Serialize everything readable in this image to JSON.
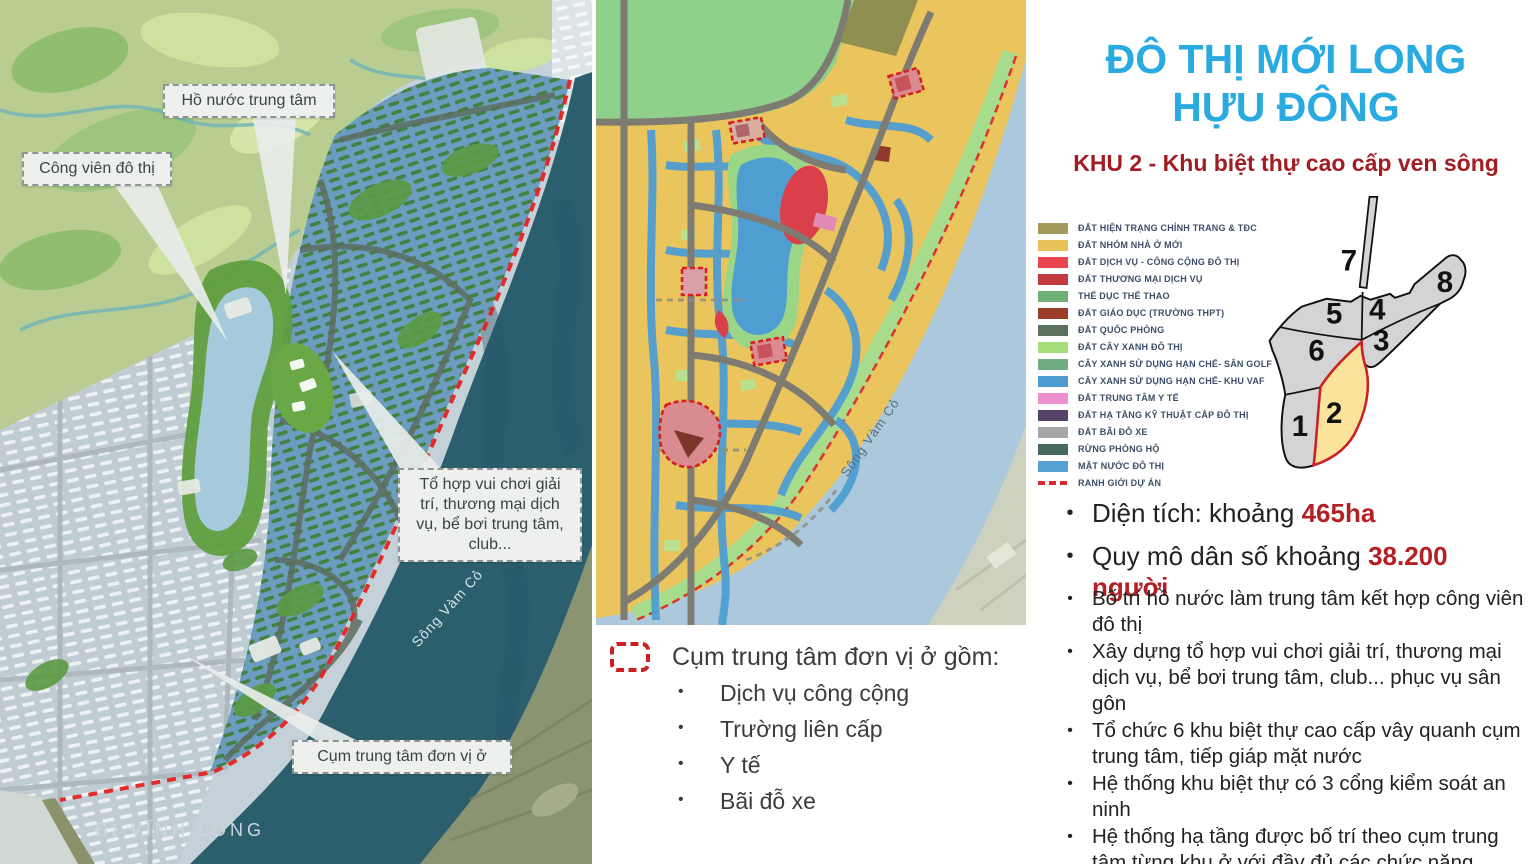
{
  "header": {
    "title_line1": "ĐÔ THỊ MỚI LONG",
    "title_line2": "HỰU ĐÔNG",
    "subtitle": "KHU 2 - Khu biệt thự cao cấp ven sông",
    "title_color": "#29abe2",
    "subtitle_color": "#a21d22"
  },
  "left_map": {
    "labels": {
      "lake": "Hồ nước trung tâm",
      "park": "Công viên đô thị",
      "complex": "Tổ hợp vui chơi giải trí, thương mại dịch vụ, bể bơi trung tâm, club...",
      "cluster": "Cụm trung tâm đơn vị ở",
      "road": "ĐI VĨNH LONG",
      "river": "Sông Vàm Cỏ"
    }
  },
  "middle_map": {
    "river_label": "Sông Vàm Cỏ"
  },
  "legend": {
    "items": [
      {
        "label": "ĐẤT HIỆN TRẠNG CHỈNH TRANG & TĐC",
        "color": "#a39a5c"
      },
      {
        "label": "ĐẤT NHÓM NHÀ Ở MỚI",
        "color": "#e5c158"
      },
      {
        "label": "ĐẤT DỊCH VỤ - CÔNG CỘNG ĐÔ THỊ",
        "color": "#e8454e"
      },
      {
        "label": "ĐẤT THƯƠNG MẠI DỊCH VỤ",
        "color": "#c13a40"
      },
      {
        "label": "THỂ DỤC THỂ THAO",
        "color": "#6eb077"
      },
      {
        "label": "ĐẤT GIÁO DỤC (TRƯỜNG THPT)",
        "color": "#9b3f2b"
      },
      {
        "label": "ĐẤT QUỐC PHÒNG",
        "color": "#5c705e"
      },
      {
        "label": "ĐẤT CÂY XANH ĐÔ THỊ",
        "color": "#a5df7b"
      },
      {
        "label": "CÂY XANH SỬ DỤNG HẠN CHẾ- SÂN GOLF",
        "color": "#6fae80"
      },
      {
        "label": "CÂY XANH SỬ DỤNG HẠN CHẾ- KHU VAF",
        "color": "#4e9cd1"
      },
      {
        "label": "ĐẤT TRUNG TÂM Y TẾ",
        "color": "#ee90d0"
      },
      {
        "label": "ĐẤT HẠ TẦNG KỸ THUẬT CẤP ĐÔ THỊ",
        "color": "#564369"
      },
      {
        "label": "ĐẤT BÃI ĐỖ XE",
        "color": "#a6a6a8"
      },
      {
        "label": "RỪNG PHÒNG HỘ",
        "color": "#48695f"
      },
      {
        "label": "MẶT NƯỚC ĐÔ THỊ",
        "color": "#55a1d3"
      },
      {
        "label": "RANH GIỚI DỰ ÁN",
        "color": "#d92b2b",
        "type": "dashed"
      }
    ]
  },
  "key_map": {
    "zones": [
      "1",
      "2",
      "3",
      "4",
      "5",
      "6",
      "7",
      "8"
    ],
    "highlight_zone": "2",
    "highlight_fill": "#fbe39b",
    "highlight_stroke": "#cc2027"
  },
  "stats": [
    {
      "prefix": "Diện tích: khoảng ",
      "highlight": "465ha"
    },
    {
      "prefix": "Quy mô dân số khoảng ",
      "highlight": "38.200 người"
    }
  ],
  "bullets": [
    "Bố trí hồ nước làm trung tâm kết hợp công viên đô thị",
    "Xây dựng tổ hợp vui chơi giải trí, thương mại dịch vụ, bể bơi trung tâm, club... phục vụ sân gôn",
    "Tổ chức 6 khu biệt thự cao cấp vây quanh cụm trung tâm, tiếp giáp mặt nước",
    "Hệ thống khu biệt thự có 3 cổng kiểm soát an ninh",
    "Hệ thống hạ tầng được bố trí theo cụm trung tâm từng khu ở với đầy đủ các chức năng HTXH"
  ],
  "cluster_note": {
    "title": "Cụm trung tâm đơn vị ở gồm:",
    "items": [
      "Dịch vụ công cộng",
      "Trường liên cấp",
      "Y tế",
      "Bãi đỗ xe"
    ]
  }
}
